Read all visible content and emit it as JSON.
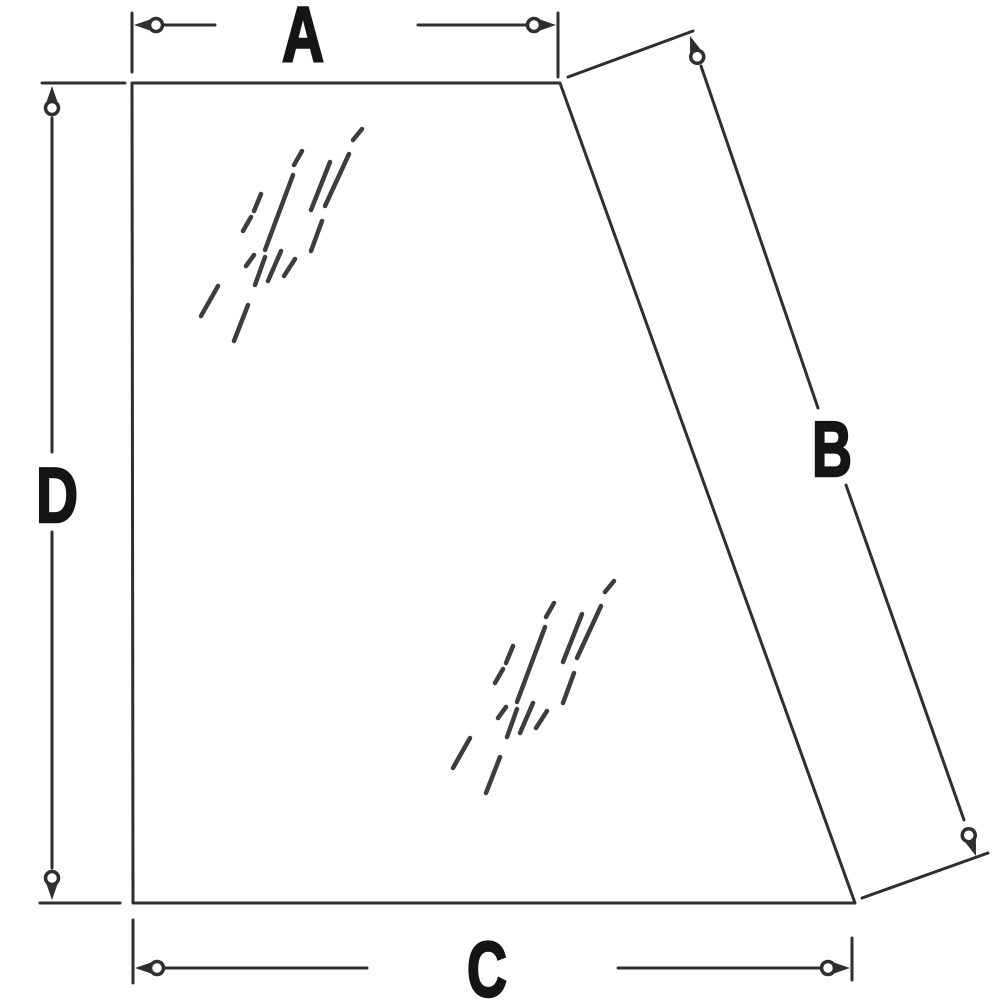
{
  "diagram": {
    "labels": {
      "a": "A",
      "b": "B",
      "c": "C",
      "d": "D"
    },
    "dimensions": [
      {
        "label": "A",
        "edge": "top"
      },
      {
        "label": "B",
        "edge": "slanted-right"
      },
      {
        "label": "C",
        "edge": "bottom"
      },
      {
        "label": "D",
        "edge": "left"
      }
    ]
  },
  "colors": {
    "bg": "#ffffff",
    "line": "#2f2f2f",
    "label": "#151515",
    "shine": "#3d3d3d"
  }
}
